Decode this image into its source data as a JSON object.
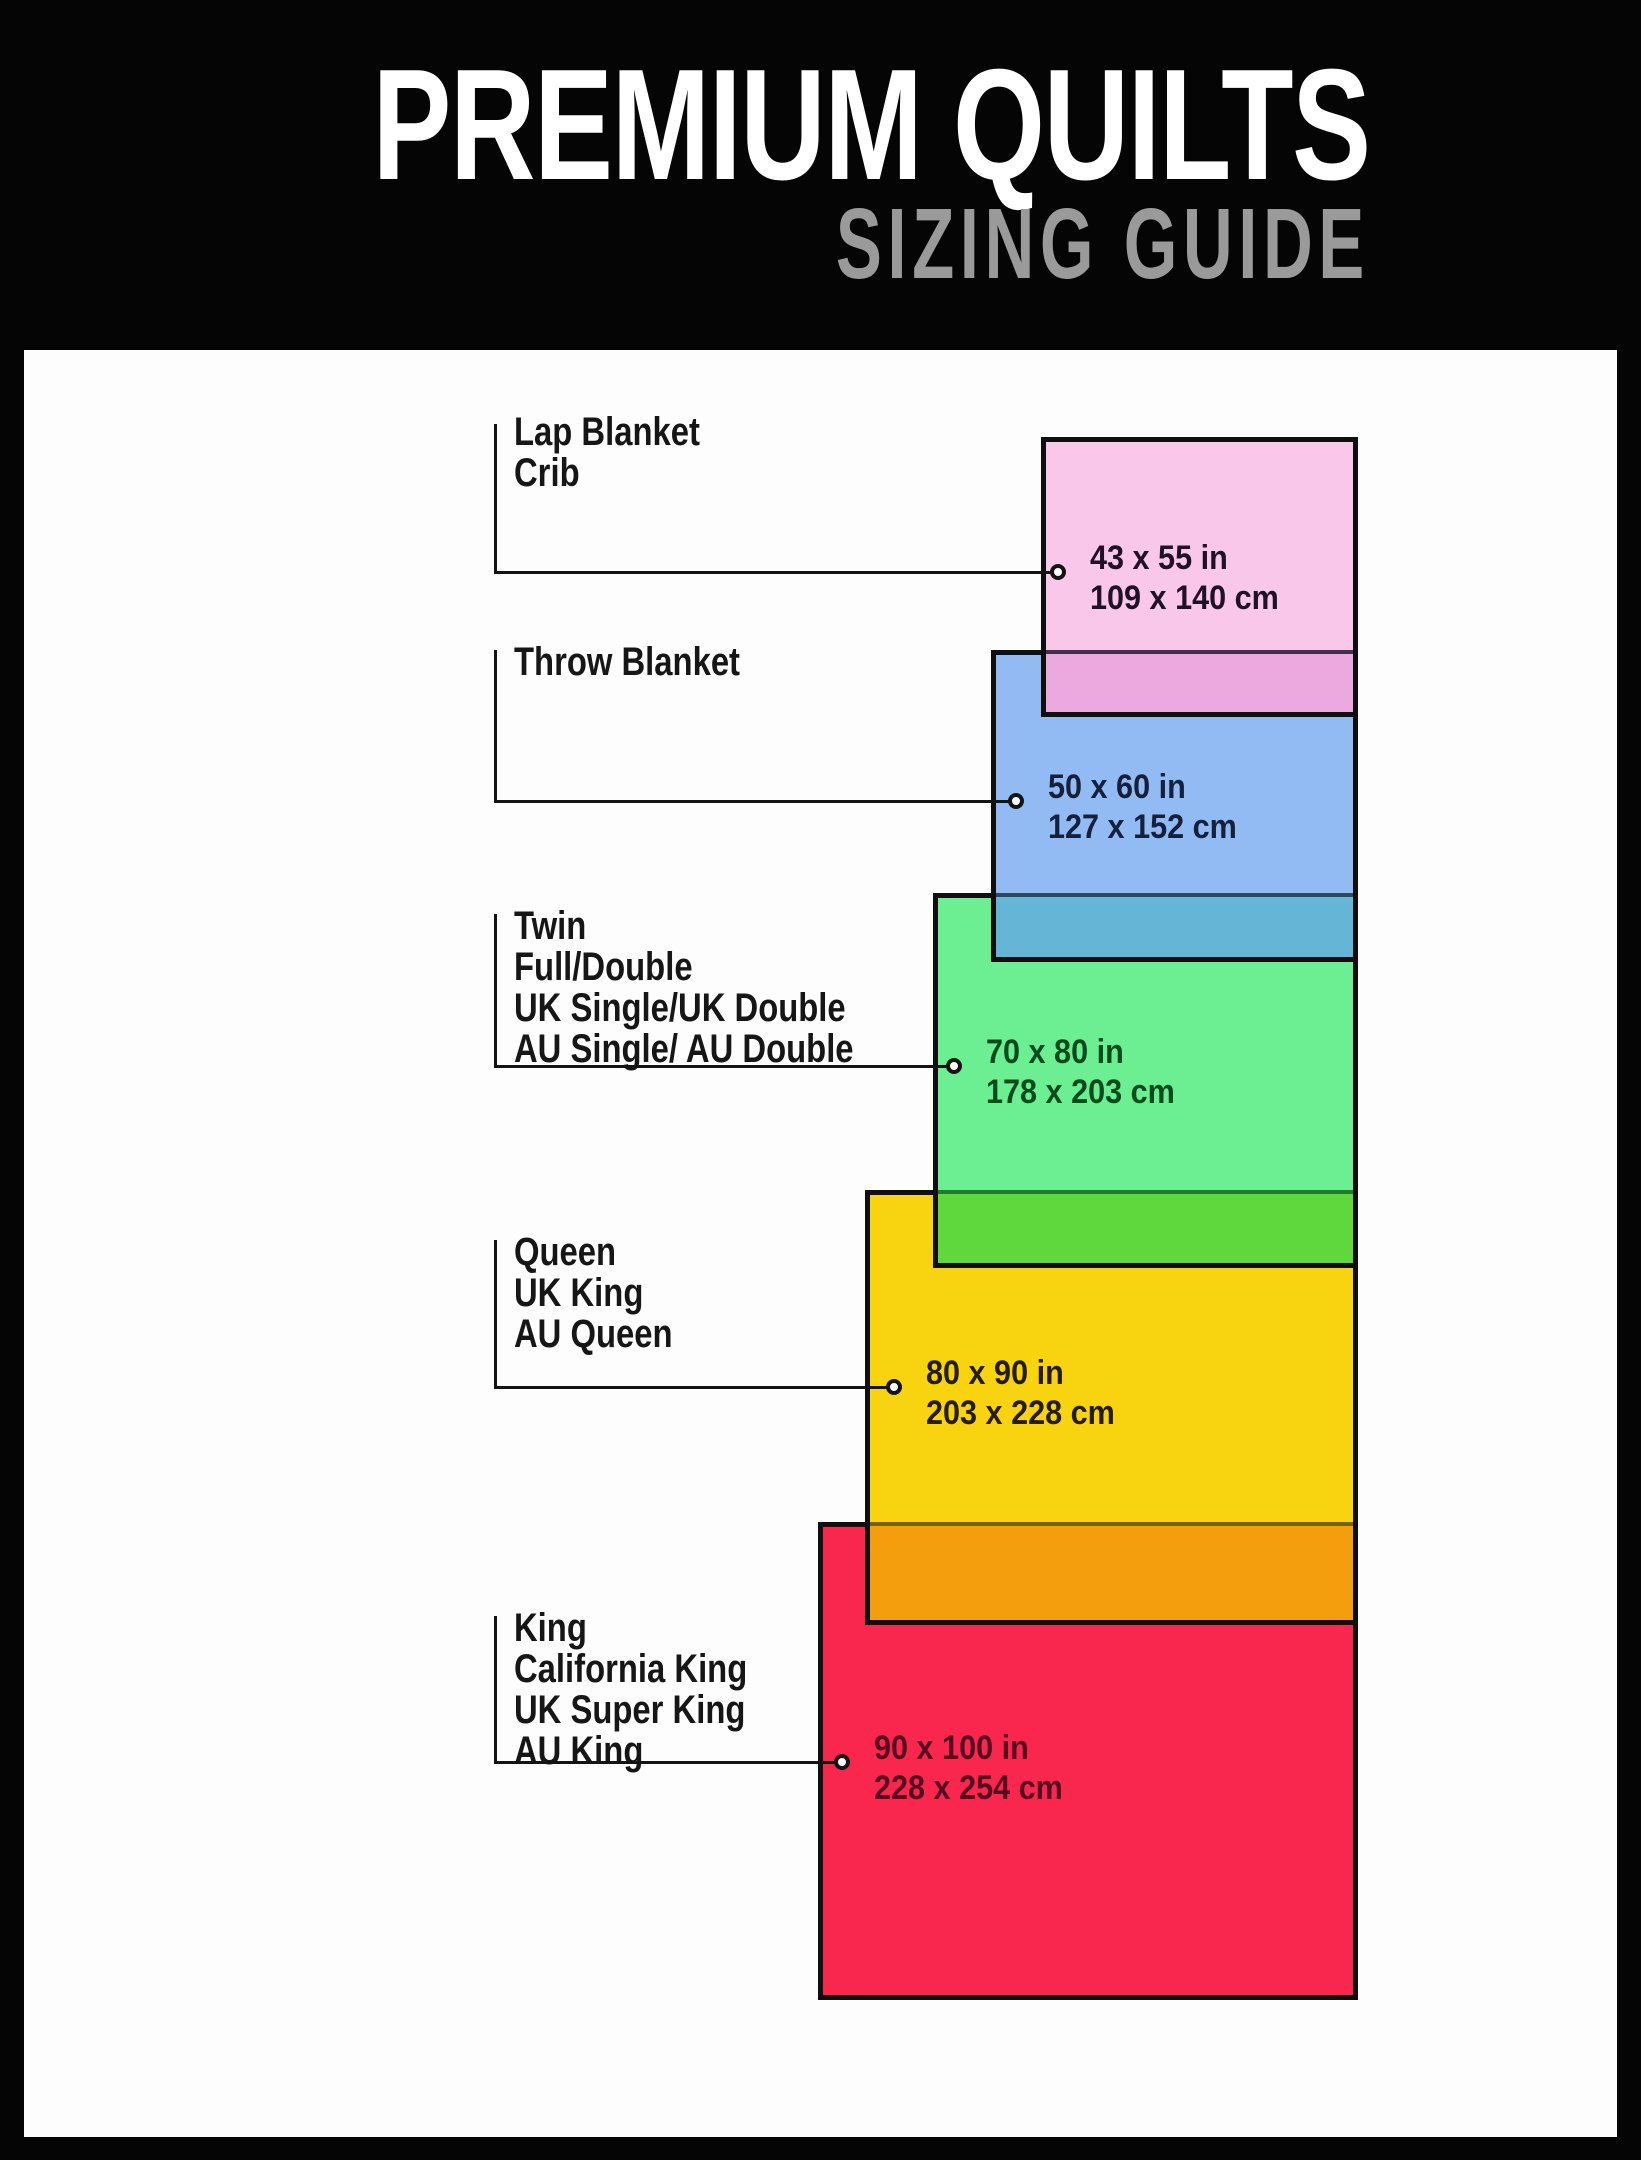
{
  "header": {
    "title": "PREMIUM QUILTS",
    "subtitle": "SIZING GUIDE",
    "title_color": "#ffffff",
    "subtitle_color": "#9a9a9a",
    "background": "#050505"
  },
  "panel": {
    "background": "#fdfdfd"
  },
  "styles": {
    "line_color": "#141414",
    "label_color": "#161616",
    "border_color": "#0f0f0f"
  },
  "sizes": [
    {
      "names": [
        "Lap Blanket",
        "Crib"
      ],
      "inches": "43 x 55 in",
      "centimeters": "109 x 140 cm",
      "fill": "#f8c7e9",
      "overlap_fill": "#eba9e0",
      "overlap_edge": "#44304e",
      "text_color": "#1f1228"
    },
    {
      "names": [
        "Throw Blanket"
      ],
      "inches": "50 x 60 in",
      "centimeters": "127 x 152 cm",
      "fill": "#92bbf3",
      "overlap_fill": "#64b5d6",
      "overlap_edge": "#31455c",
      "text_color": "#14203c"
    },
    {
      "names": [
        "Twin",
        "Full/Double",
        "UK Single/UK Double",
        "AU Single/ AU Double"
      ],
      "inches": "70 x 80 in",
      "centimeters": "178 x 203 cm",
      "fill": "#6cee92",
      "overlap_fill": "#5ed83c",
      "overlap_edge": "#1f7d2a",
      "text_color": "#0b4a1a"
    },
    {
      "names": [
        "Queen",
        "UK King",
        "AU Queen"
      ],
      "inches": "80 x 90 in",
      "centimeters": "203 x 228 cm",
      "fill": "#f8d410",
      "overlap_fill": "#f59e0d",
      "overlap_edge": "#7a600c",
      "text_color": "#241c03"
    },
    {
      "names": [
        "King",
        "California King",
        "UK Super King",
        "AU King"
      ],
      "inches": "90 x 100 in",
      "centimeters": "228 x 254 cm",
      "fill": "#f9274d",
      "text_color": "#550a20"
    }
  ]
}
